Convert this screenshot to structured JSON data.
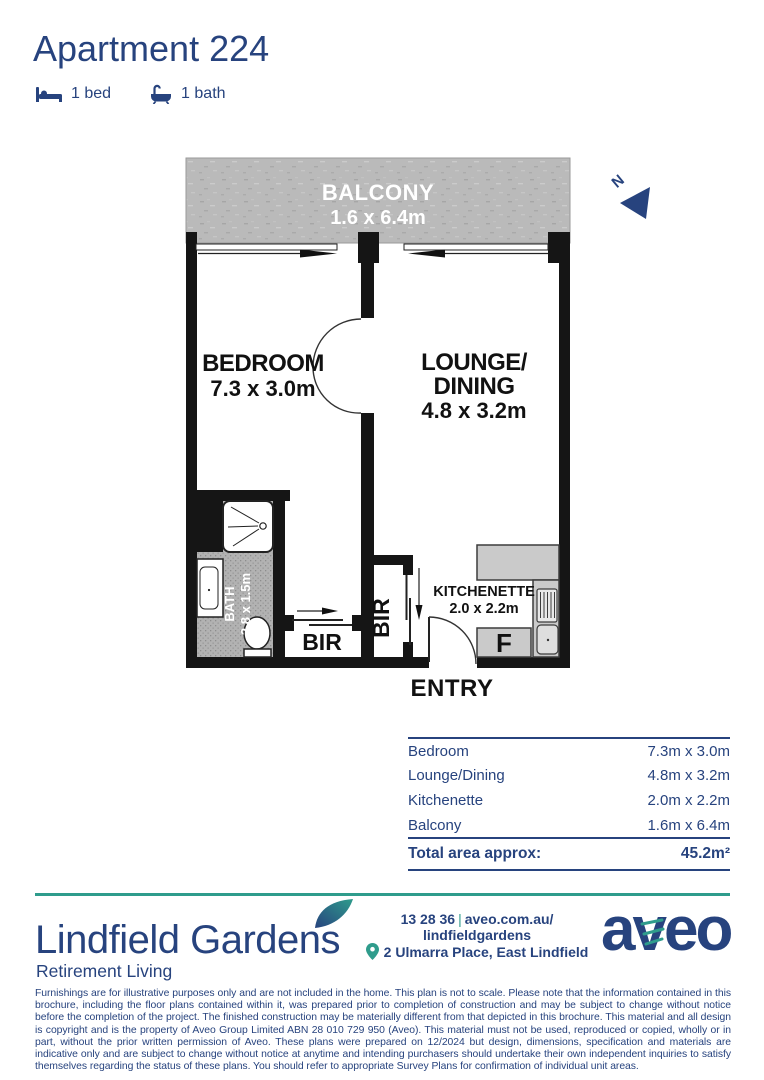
{
  "header": {
    "title": "Apartment 224",
    "beds_label": "1 bed",
    "baths_label": "1 bath"
  },
  "plan": {
    "balcony_name": "BALCONY",
    "balcony_dims": "1.6 x 6.4m",
    "bedroom_name": "BEDROOM",
    "bedroom_dims": "7.3 x 3.0m",
    "lounge_name_1": "LOUNGE/",
    "lounge_name_2": "DINING",
    "lounge_dims": "4.8 x 3.2m",
    "kitchenette_name": "KITCHENETTE",
    "kitchenette_dims": "2.0 x 2.2m",
    "bath_name": "BATH",
    "bath_dims": "2.8 x 1.5m",
    "bir_left_label": "BIR",
    "bir_middle_label": "BIR",
    "entry_label": "ENTRY",
    "fridge_label": "F",
    "north_label": "N"
  },
  "area_table": {
    "rows": [
      {
        "label": "Bedroom",
        "value": "7.3m x 3.0m"
      },
      {
        "label": "Lounge/Dining",
        "value": "4.8m x 3.2m"
      },
      {
        "label": "Kitchenette",
        "value": "2.0m x 2.2m"
      },
      {
        "label": "Balcony",
        "value": "1.6m x 6.4m"
      }
    ],
    "total_label": "Total area approx:",
    "total_value": "45.2m²"
  },
  "footer": {
    "community_name": "Lindfield Gardens",
    "community_tagline": "Retirement Living",
    "phone": "13 28 36",
    "separator": "|",
    "website_line1": "aveo.com.au/",
    "website_line2": "lindfieldgardens",
    "address": "2 Ulmarra Place, East Lindfield",
    "brand": "aveo",
    "colors": {
      "navy": "#27437e",
      "teal": "#2f9c8c"
    }
  },
  "disclaimer": "Furnishings are for illustrative purposes only and are not included in the home. This plan is not to scale. Please note that the information contained in this brochure, including the floor plans contained within it, was prepared prior to completion of construction and may be subject to change without notice before the completion of the project. The finished construction may be materially different from that depicted in this brochure. This material and all design is copyright and is the property of Aveo Group Limited ABN 28 010 729 950 (Aveo). This material must not be used, reproduced or copied, wholly or in part, without the prior written permission of Aveo. These plans were prepared on 12/2024 but design, dimensions, specification and materials are indicative only and are subject to change without notice at anytime and intending purchasers should undertake their own independent inquiries to satisfy themselves regarding the status of these plans. You should refer to appropriate Survey Plans for confirmation of individual unit areas."
}
